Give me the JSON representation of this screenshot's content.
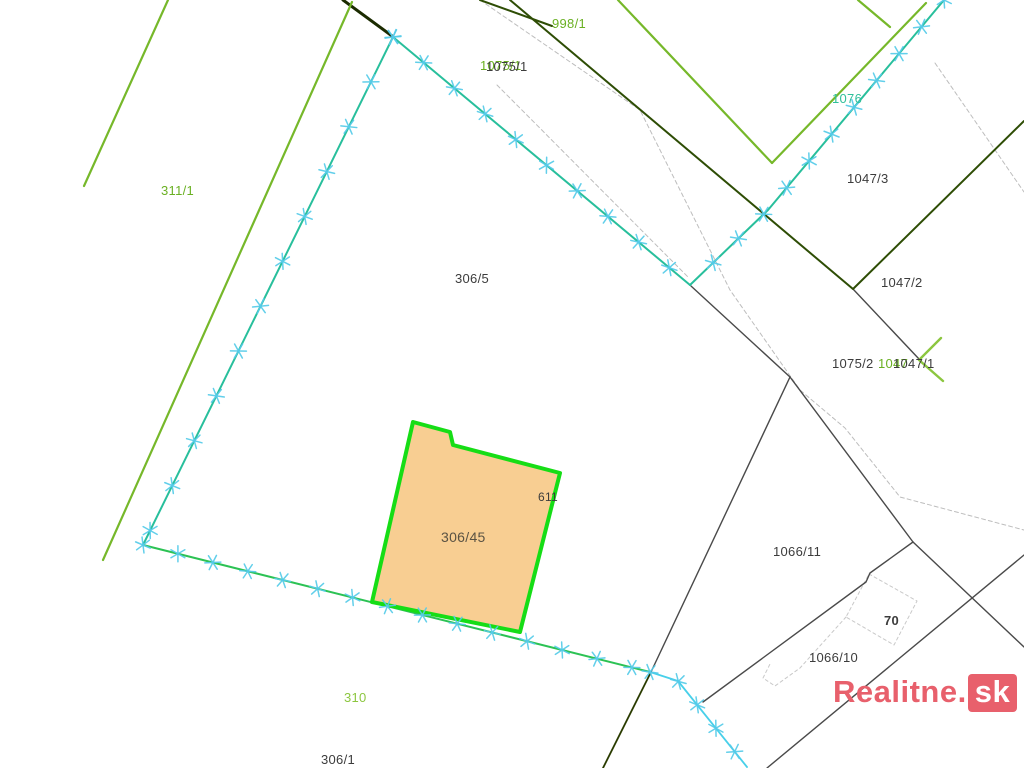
{
  "watermark": {
    "text": "Realitne.",
    "suffix": "sk",
    "color": "#e8606c"
  },
  "map": {
    "background": "#ffffff",
    "colors": {
      "dark": "#3c3c3c",
      "green": "#6ab023",
      "lightgreen": "#8cc63f",
      "teal": "#2fbf9a",
      "brown": "#5a5243",
      "cross": "#55cbe9",
      "parcel_fill": "#f8ce92",
      "parcel_stroke": "#16dd16",
      "chain_teal": "#28bf9c",
      "chain_green": "#2cc254",
      "chain_cyan": "#48d0ea",
      "darkgreen": "#2e4d05",
      "black_line": "#4a4a4a",
      "road_dash": "#bdbdbd",
      "building_dash": "#c9c9c9"
    },
    "highlight_parcel": {
      "label": "306/45",
      "points": [
        [
          413,
          422
        ],
        [
          450,
          432
        ],
        [
          453,
          445
        ],
        [
          560,
          473
        ],
        [
          520,
          632
        ],
        [
          372,
          602
        ]
      ]
    },
    "lines": [
      {
        "name": "road-dash-right",
        "color": "#bdbdbd",
        "width": 1,
        "dash": "4 3",
        "points": [
          [
            480,
            0
          ],
          [
            640,
            110
          ],
          [
            730,
            290
          ],
          [
            800,
            390
          ],
          [
            845,
            428
          ],
          [
            900,
            497
          ],
          [
            1024,
            530
          ]
        ]
      },
      {
        "name": "road-dash-left",
        "color": "#bdbdbd",
        "width": 1,
        "dash": "4 3",
        "points": [
          [
            497,
            85
          ],
          [
            688,
            277
          ]
        ]
      },
      {
        "name": "road-dash-topright",
        "color": "#bdbdbd",
        "width": 1,
        "dash": "4 3",
        "points": [
          [
            935,
            63
          ],
          [
            1024,
            192
          ]
        ]
      },
      {
        "name": "building-70-outline",
        "color": "#c9c9c9",
        "width": 1,
        "dash": "3 3",
        "points": [
          [
            869,
            574
          ],
          [
            917,
            601
          ],
          [
            894,
            645
          ],
          [
            846,
            617
          ],
          [
            869,
            574
          ]
        ]
      },
      {
        "name": "building-1066-outline",
        "color": "#c9c9c9",
        "width": 1,
        "dash": "3 3",
        "points": [
          [
            846,
            617
          ],
          [
            800,
            668
          ],
          [
            775,
            686
          ],
          [
            763,
            678
          ],
          [
            770,
            664
          ]
        ]
      },
      {
        "name": "black-junction-east",
        "color": "#4a4a4a",
        "width": 1.4,
        "points": [
          [
            691,
            286
          ],
          [
            790,
            377
          ]
        ]
      },
      {
        "name": "black-to-south-junction",
        "color": "#4a4a4a",
        "width": 1.4,
        "points": [
          [
            790,
            377
          ],
          [
            651,
            672
          ]
        ]
      },
      {
        "name": "black-1066-11-upper",
        "color": "#4a4a4a",
        "width": 1.4,
        "points": [
          [
            790,
            377
          ],
          [
            913,
            542
          ]
        ]
      },
      {
        "name": "black-southeast-1",
        "color": "#4a4a4a",
        "width": 1.4,
        "points": [
          [
            913,
            542
          ],
          [
            1024,
            647
          ]
        ]
      },
      {
        "name": "black-1066-11-lower",
        "color": "#4a4a4a",
        "width": 1.4,
        "points": [
          [
            913,
            542
          ],
          [
            870,
            573
          ],
          [
            866,
            582
          ],
          [
            703,
            702
          ]
        ]
      },
      {
        "name": "black-below-70",
        "color": "#4a4a4a",
        "width": 1.4,
        "points": [
          [
            767,
            768
          ],
          [
            1024,
            555
          ]
        ]
      },
      {
        "name": "black-1047-link",
        "color": "#4a4a4a",
        "width": 1.4,
        "points": [
          [
            853,
            289
          ],
          [
            919,
            359
          ]
        ]
      },
      {
        "name": "darkolive-south",
        "color": "#2a3b00",
        "width": 1.8,
        "points": [
          [
            651,
            672
          ],
          [
            603,
            768
          ]
        ]
      },
      {
        "name": "darkgreen-top-thick",
        "color": "#1b2b00",
        "width": 3,
        "points": [
          [
            343,
            0
          ],
          [
            392,
            36
          ]
        ]
      },
      {
        "name": "darkgreen-main",
        "color": "#2e4d05",
        "width": 2,
        "points": [
          [
            510,
            0
          ],
          [
            853,
            289
          ],
          [
            1024,
            121
          ]
        ]
      },
      {
        "name": "darkgreen-stub",
        "color": "#2e4d05",
        "width": 2,
        "points": [
          [
            480,
            0
          ],
          [
            552,
            26
          ]
        ]
      },
      {
        "name": "lightgreen-left-short",
        "color": "#76b82a",
        "width": 2.2,
        "points": [
          [
            168,
            0
          ],
          [
            84,
            186
          ]
        ]
      },
      {
        "name": "lightgreen-long-west",
        "color": "#76b82a",
        "width": 2.2,
        "points": [
          [
            352,
            2
          ],
          [
            103,
            560
          ]
        ]
      },
      {
        "name": "lightgreen-ne-a",
        "color": "#76b82a",
        "width": 2.2,
        "points": [
          [
            618,
            0
          ],
          [
            772,
            163
          ]
        ]
      },
      {
        "name": "lightgreen-ne-b",
        "color": "#76b82a",
        "width": 2.2,
        "points": [
          [
            772,
            163
          ],
          [
            926,
            3
          ]
        ]
      },
      {
        "name": "lightgreen-ne-c",
        "color": "#76b82a",
        "width": 2.2,
        "points": [
          [
            858,
            0
          ],
          [
            890,
            27
          ]
        ]
      },
      {
        "name": "lightgreen-1047-1-chevron",
        "color": "#8cc63f",
        "width": 2.4,
        "points": [
          [
            941,
            338
          ],
          [
            919,
            360
          ],
          [
            943,
            381
          ]
        ]
      },
      {
        "name": "boundary-306-5-left",
        "color": "#28bf9c",
        "width": 2,
        "crosses": true,
        "spacing": 50,
        "points": [
          [
            393,
            37
          ],
          [
            143,
            545
          ]
        ]
      },
      {
        "name": "boundary-306-5-main",
        "color": "#28bf9c",
        "width": 2,
        "crosses": true,
        "spacing": 40,
        "points": [
          [
            393,
            37
          ],
          [
            690,
            285
          ]
        ]
      },
      {
        "name": "boundary-1076-chain",
        "color": "#28bf9c",
        "width": 2,
        "crosses": true,
        "spacing": 35,
        "points": [
          [
            944,
            0
          ],
          [
            768,
            210
          ],
          [
            690,
            285
          ]
        ]
      },
      {
        "name": "boundary-south-chain",
        "color": "#2cc254",
        "width": 2,
        "crosses": true,
        "spacing": 36,
        "points": [
          [
            143,
            545
          ],
          [
            650,
            672
          ]
        ]
      },
      {
        "name": "boundary-cyan-chain",
        "color": "#48d0ea",
        "width": 1.8,
        "crosses": true,
        "spacing": 30,
        "points": [
          [
            650,
            672
          ],
          [
            678,
            681
          ],
          [
            747,
            767
          ]
        ]
      }
    ],
    "labels": [
      {
        "text": "998/1",
        "x": 552,
        "y": 28,
        "color": "green",
        "size": 13
      },
      {
        "text": "1075/1",
        "x": 480,
        "y": 70,
        "color": "green",
        "size": 13
      },
      {
        "text": "1075/1",
        "x": 486,
        "y": 71,
        "color": "dark",
        "size": 13
      },
      {
        "text": "1076",
        "x": 832,
        "y": 103,
        "color": "teal",
        "size": 13
      },
      {
        "text": "1047/3",
        "x": 847,
        "y": 183,
        "color": "dark",
        "size": 13
      },
      {
        "text": "311/1",
        "x": 161,
        "y": 195,
        "color": "green",
        "size": 13
      },
      {
        "text": "306/5",
        "x": 455,
        "y": 283,
        "color": "dark",
        "size": 13
      },
      {
        "text": "1047/2",
        "x": 881,
        "y": 287,
        "color": "dark",
        "size": 13
      },
      {
        "text": "1075/2",
        "x": 832,
        "y": 368,
        "color": "dark",
        "size": 13
      },
      {
        "text": "1047",
        "x": 878,
        "y": 368,
        "color": "green",
        "size": 13
      },
      {
        "text": "1047/1",
        "x": 893,
        "y": 368,
        "color": "dark",
        "size": 13
      },
      {
        "text": "611",
        "x": 538,
        "y": 501,
        "color": "dark",
        "size": 12
      },
      {
        "text": "306/45",
        "x": 441,
        "y": 542,
        "color": "brown",
        "size": 14
      },
      {
        "text": "1066/11",
        "x": 773,
        "y": 556,
        "color": "dark",
        "size": 13
      },
      {
        "text": "70",
        "x": 884,
        "y": 625,
        "color": "dark",
        "size": 13,
        "bold": true
      },
      {
        "text": "1066/10",
        "x": 809,
        "y": 662,
        "color": "dark",
        "size": 13
      },
      {
        "text": "310",
        "x": 344,
        "y": 702,
        "color": "lightgreen",
        "size": 13
      },
      {
        "text": "306/1",
        "x": 321,
        "y": 764,
        "color": "dark",
        "size": 13
      }
    ]
  }
}
